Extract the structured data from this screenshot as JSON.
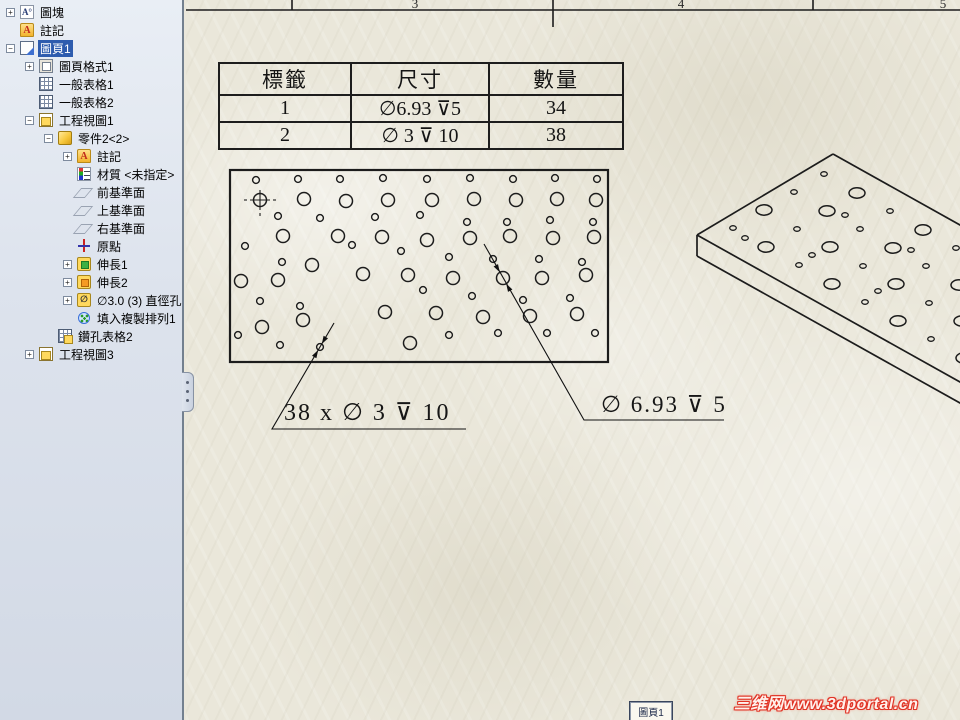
{
  "app": {
    "title": "SolidWorks drawing — 圖頁1"
  },
  "feature_tree": {
    "items": [
      {
        "label": "圖塊",
        "level": 0,
        "expand": "+",
        "icon": "block"
      },
      {
        "label": "註記",
        "level": 0,
        "expand": "",
        "icon": "annot-folder"
      },
      {
        "label": "圖頁1",
        "level": 0,
        "expand": "-",
        "icon": "sheet",
        "selected": true
      },
      {
        "label": "圖頁格式1",
        "level": 1,
        "expand": "+",
        "icon": "sheet-format"
      },
      {
        "label": "一般表格1",
        "level": 1,
        "expand": "",
        "icon": "table"
      },
      {
        "label": "一般表格2",
        "level": 1,
        "expand": "",
        "icon": "table"
      },
      {
        "label": "工程視圖1",
        "level": 1,
        "expand": "-",
        "icon": "drawing-view"
      },
      {
        "label": "零件2<2>",
        "level": 2,
        "expand": "-",
        "icon": "part"
      },
      {
        "label": "註記",
        "level": 3,
        "expand": "+",
        "icon": "annot-folder"
      },
      {
        "label": "材質 <未指定>",
        "level": 3,
        "expand": "",
        "icon": "material"
      },
      {
        "label": "前基準面",
        "level": 3,
        "expand": "",
        "icon": "plane"
      },
      {
        "label": "上基準面",
        "level": 3,
        "expand": "",
        "icon": "plane"
      },
      {
        "label": "右基準面",
        "level": 3,
        "expand": "",
        "icon": "plane"
      },
      {
        "label": "原點",
        "level": 3,
        "expand": "",
        "icon": "origin"
      },
      {
        "label": "伸長1",
        "level": 3,
        "expand": "+",
        "icon": "extrude1"
      },
      {
        "label": "伸長2",
        "level": 3,
        "expand": "+",
        "icon": "extrude2"
      },
      {
        "label": "∅3.0 (3) 直徑孔1",
        "level": 3,
        "expand": "+",
        "icon": "hole-feature"
      },
      {
        "label": "填入複製排列1",
        "level": 3,
        "expand": "",
        "icon": "fill-pattern"
      },
      {
        "label": "鑽孔表格2",
        "level": 2,
        "expand": "",
        "icon": "hole-table"
      },
      {
        "label": "工程視圖3",
        "level": 1,
        "expand": "+",
        "icon": "drawing-view"
      }
    ]
  },
  "zones": {
    "hline_y": 10,
    "ticks": [
      {
        "x": 292,
        "y2": 10
      },
      {
        "x": 553,
        "y2": 27
      },
      {
        "x": 813,
        "y2": 10
      }
    ],
    "digits": [
      {
        "text": "3",
        "x": 415
      },
      {
        "text": "4",
        "x": 681
      },
      {
        "text": "5",
        "x": 943
      }
    ]
  },
  "hole_table": {
    "columns": [
      "標籤",
      "尺寸",
      "數量"
    ],
    "rows": [
      [
        "1",
        "∅6.93 ⊽5",
        "34"
      ],
      [
        "2",
        "∅ 3 ⊽ 10",
        "38"
      ]
    ]
  },
  "front_view": {
    "rect": {
      "x": 230,
      "y": 170,
      "w": 378,
      "h": 192
    },
    "r_large": 6.5,
    "r_small": 3.4,
    "origin": {
      "x": 260,
      "y": 200
    },
    "large": [
      [
        260,
        200
      ],
      [
        304,
        199
      ],
      [
        346,
        201
      ],
      [
        388,
        200
      ],
      [
        432,
        200
      ],
      [
        474,
        199
      ],
      [
        516,
        200
      ],
      [
        557,
        199
      ],
      [
        596,
        200
      ],
      [
        283,
        236
      ],
      [
        338,
        236
      ],
      [
        382,
        237
      ],
      [
        427,
        240
      ],
      [
        470,
        238
      ],
      [
        510,
        236
      ],
      [
        553,
        238
      ],
      [
        594,
        237
      ],
      [
        241,
        281
      ],
      [
        278,
        280
      ],
      [
        312,
        265
      ],
      [
        363,
        274
      ],
      [
        408,
        275
      ],
      [
        453,
        278
      ],
      [
        503,
        278
      ],
      [
        542,
        278
      ],
      [
        586,
        275
      ],
      [
        262,
        327
      ],
      [
        303,
        320
      ],
      [
        385,
        312
      ],
      [
        436,
        313
      ],
      [
        483,
        317
      ],
      [
        530,
        316
      ],
      [
        577,
        314
      ],
      [
        410,
        343
      ]
    ],
    "small": [
      [
        256,
        180
      ],
      [
        298,
        179
      ],
      [
        340,
        179
      ],
      [
        383,
        178
      ],
      [
        427,
        179
      ],
      [
        470,
        178
      ],
      [
        513,
        179
      ],
      [
        555,
        178
      ],
      [
        597,
        179
      ],
      [
        278,
        216
      ],
      [
        320,
        218
      ],
      [
        375,
        217
      ],
      [
        420,
        215
      ],
      [
        467,
        222
      ],
      [
        507,
        222
      ],
      [
        550,
        220
      ],
      [
        593,
        222
      ],
      [
        245,
        246
      ],
      [
        282,
        262
      ],
      [
        352,
        245
      ],
      [
        401,
        251
      ],
      [
        449,
        257
      ],
      [
        493,
        259
      ],
      [
        539,
        259
      ],
      [
        582,
        262
      ],
      [
        260,
        301
      ],
      [
        300,
        306
      ],
      [
        423,
        290
      ],
      [
        472,
        296
      ],
      [
        523,
        300
      ],
      [
        570,
        298
      ],
      [
        238,
        335
      ],
      [
        280,
        345
      ],
      [
        320,
        347
      ],
      [
        449,
        335
      ],
      [
        498,
        333
      ],
      [
        547,
        333
      ],
      [
        595,
        333
      ]
    ]
  },
  "iso_view": {
    "lines": [
      [
        833,
        154,
        697,
        235
      ],
      [
        833,
        154,
        985,
        239
      ],
      [
        697,
        235,
        985,
        396
      ],
      [
        697,
        235,
        697,
        256
      ],
      [
        697,
        256,
        985,
        417
      ]
    ],
    "rx_large": 8,
    "ry_large": 5.2,
    "rx_small": 3.3,
    "ry_small": 2.3,
    "large": [
      [
        766,
        247
      ],
      [
        832,
        284
      ],
      [
        898,
        321
      ],
      [
        964,
        358
      ],
      [
        764,
        210
      ],
      [
        830,
        247
      ],
      [
        896,
        284
      ],
      [
        962,
        321
      ],
      [
        827,
        211
      ],
      [
        893,
        248
      ],
      [
        959,
        285
      ],
      [
        857,
        193
      ],
      [
        923,
        230
      ]
    ],
    "small": [
      [
        733,
        228
      ],
      [
        799,
        265
      ],
      [
        865,
        302
      ],
      [
        931,
        339
      ],
      [
        797,
        229
      ],
      [
        863,
        266
      ],
      [
        929,
        303
      ],
      [
        794,
        192
      ],
      [
        860,
        229
      ],
      [
        926,
        266
      ],
      [
        824,
        174
      ],
      [
        890,
        211
      ],
      [
        956,
        248
      ],
      [
        745,
        238
      ],
      [
        812,
        255
      ],
      [
        878,
        291
      ],
      [
        911,
        250
      ],
      [
        845,
        215
      ]
    ]
  },
  "callouts": [
    {
      "text": "38 x ∅ 3 ⊽ 10",
      "font_px": 24,
      "tx": 284,
      "ty": 398,
      "pts": [
        [
          334,
          323
        ],
        [
          272,
          429
        ],
        [
          466,
          429
        ]
      ],
      "arrows": [
        [
          [
            321.8,
            344
          ],
          [
            323.6,
            335.8
          ],
          [
            328,
            338.4
          ]
        ],
        [
          [
            318.2,
            350
          ],
          [
            316.4,
            358.2
          ],
          [
            312,
            355.7
          ]
        ]
      ]
    },
    {
      "text": "∅ 6.93 ⊽ 5",
      "font_px": 23,
      "tx": 601,
      "ty": 392,
      "pts": [
        [
          484,
          244
        ],
        [
          584,
          420
        ],
        [
          724,
          420
        ]
      ],
      "arrows": [
        [
          [
            499.8,
            272.3
          ],
          [
            493.6,
            266.5
          ],
          [
            498,
            264.1
          ]
        ],
        [
          [
            506.2,
            283.7
          ],
          [
            512.4,
            289.5
          ],
          [
            508,
            291.9
          ]
        ]
      ]
    }
  ],
  "sheet_tab": {
    "label": "圖頁1"
  },
  "watermark": {
    "text": "三维网www.3dportal.cn",
    "color": "#e03325"
  },
  "colors": {
    "paper": "#eae7da",
    "line": "#1c1c1c",
    "panel": "#dde3ed",
    "selection": "#2e5cae",
    "watermark_red": "#e03325"
  }
}
